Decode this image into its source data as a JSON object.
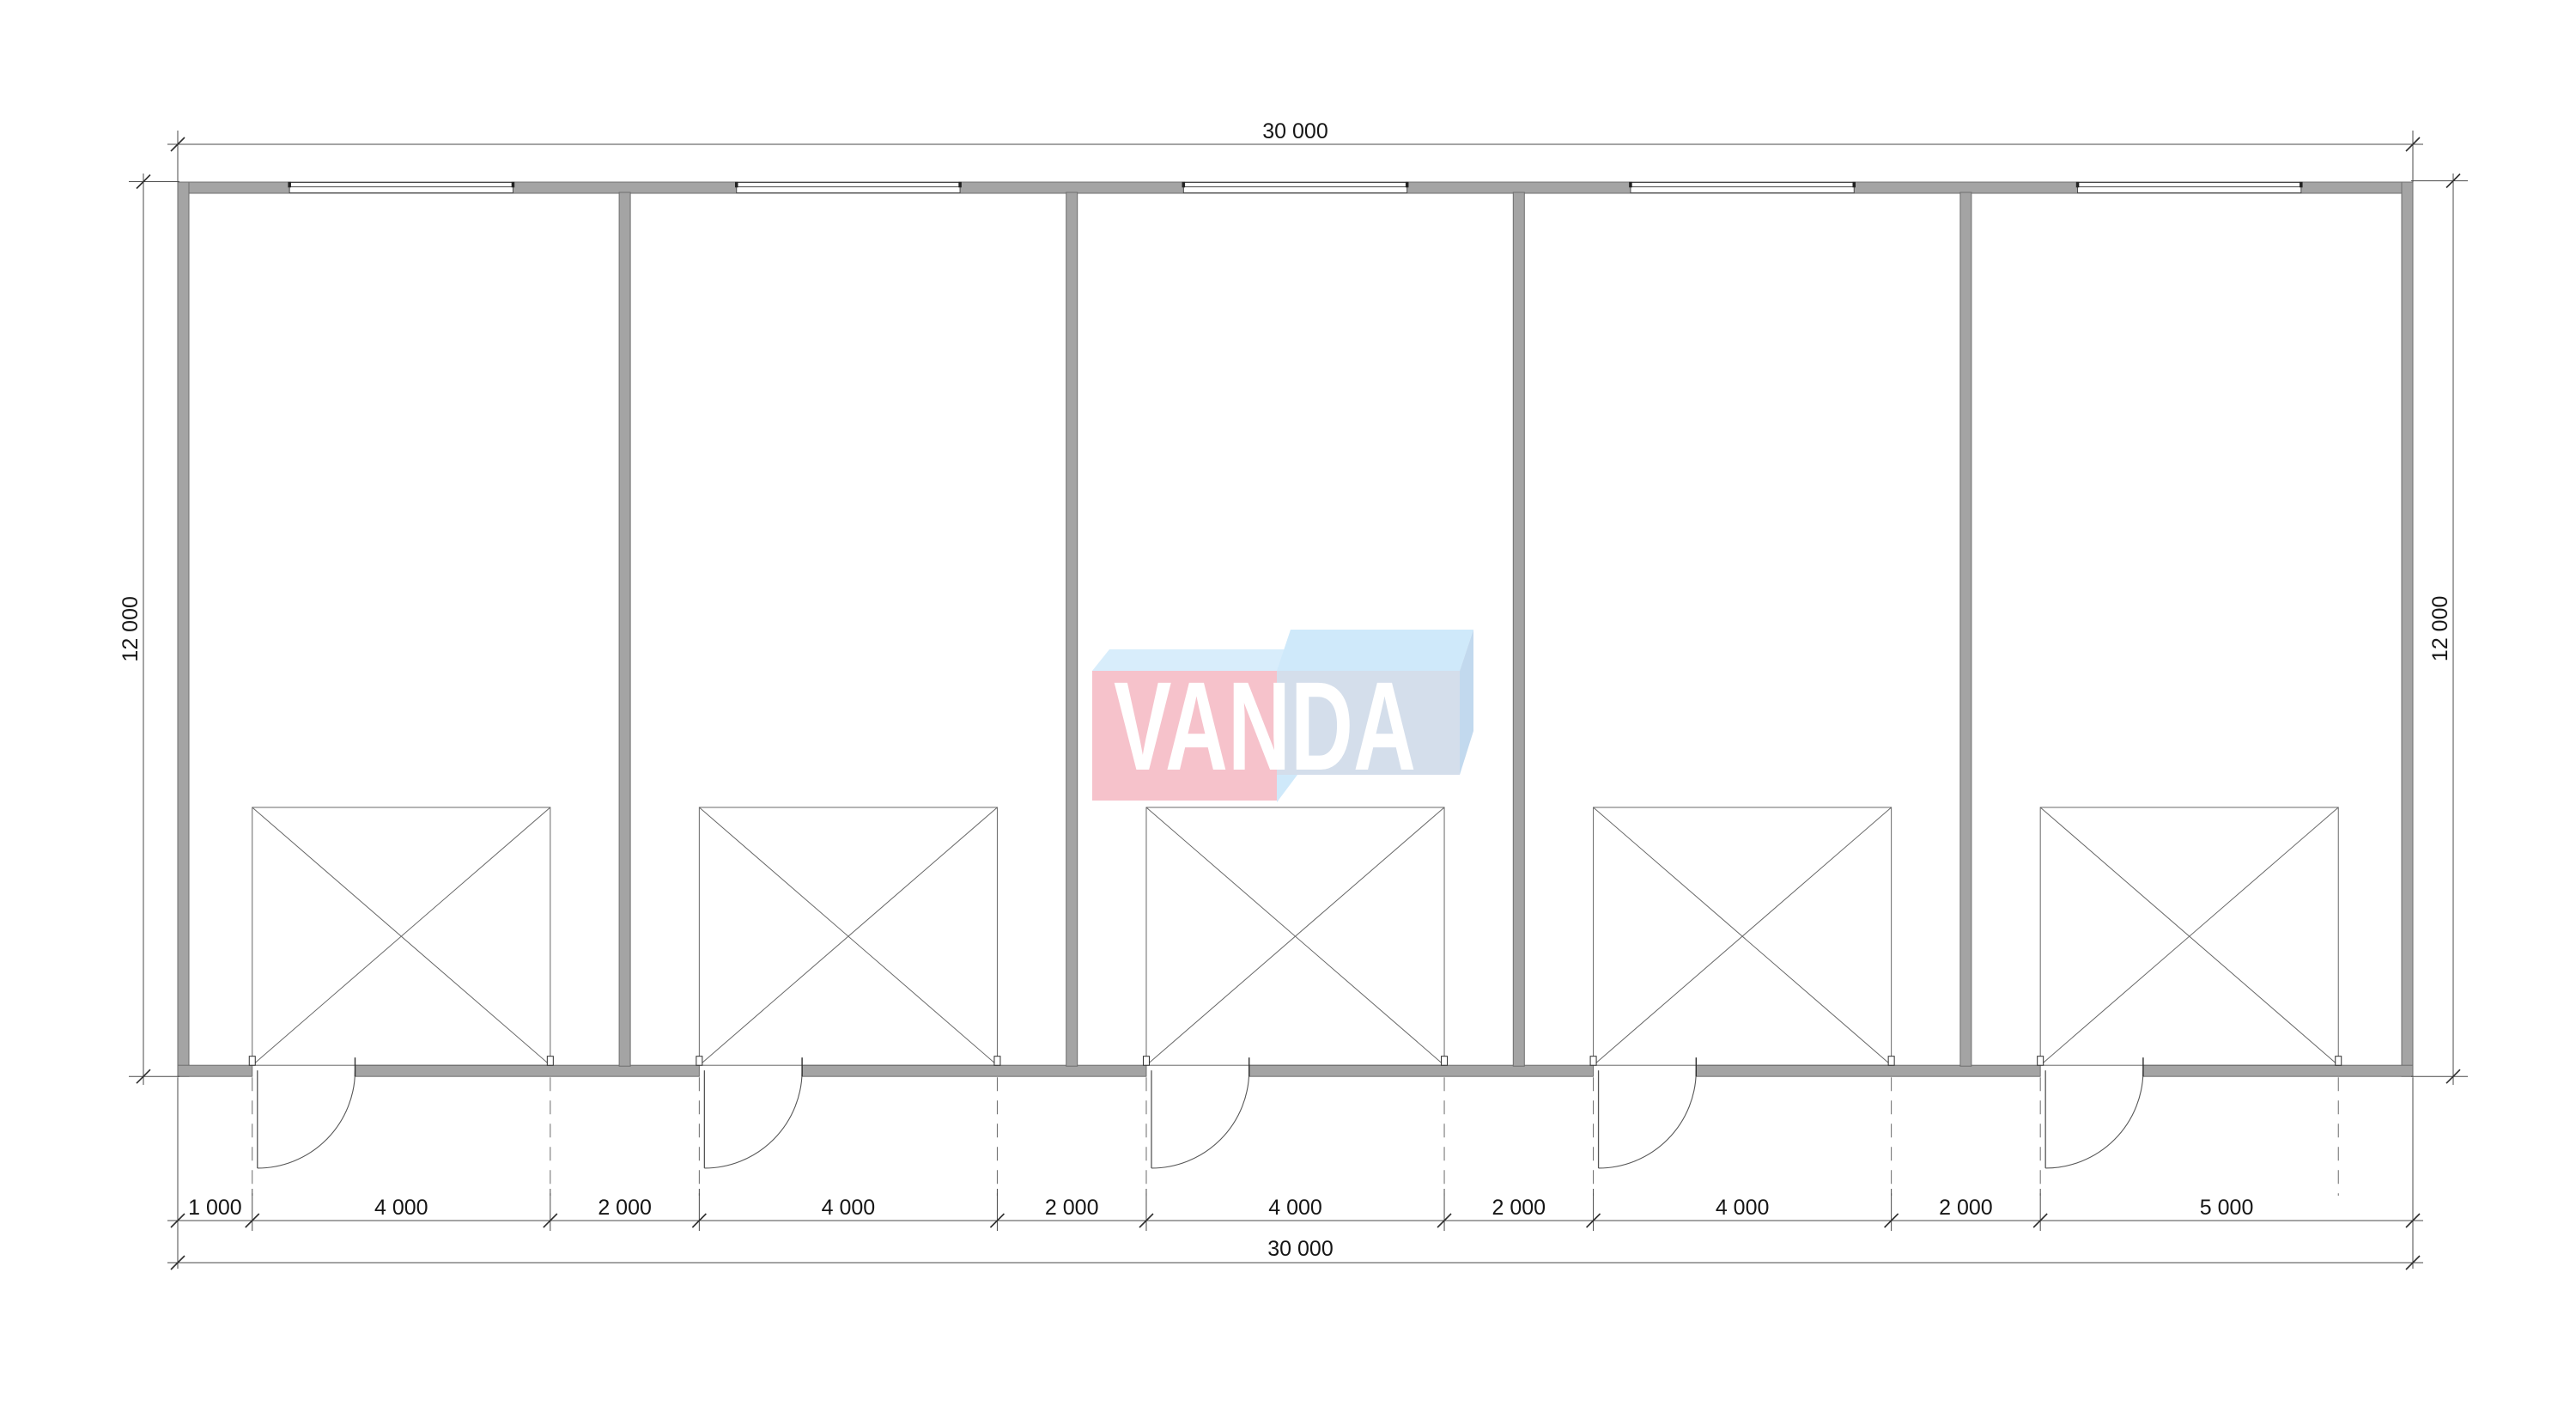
{
  "logo": {
    "text": "VANDA",
    "pink": "#f6c2cb",
    "sky": "#d8edfb",
    "sky2": "#cfe9fa",
    "face": "#d4deeb",
    "side": "#c2d9ee",
    "text_color": "#ffffff"
  },
  "dimensions": {
    "top_overall": "30 000",
    "bottom_overall": "30 000",
    "left_overall": "12 000",
    "right_overall": "12 000",
    "bottom_chain_labels": [
      "1 000",
      "4 000",
      "2 000",
      "4 000",
      "2 000",
      "4 000",
      "2 000",
      "4 000",
      "2 000",
      "5 000"
    ]
  },
  "plan": {
    "building_width_mm": 30000,
    "building_depth_mm": 12000,
    "unit_count": 5,
    "wall_thickness_mm": 150,
    "chain_points_mm": [
      0,
      1000,
      5000,
      7000,
      11000,
      13000,
      17000,
      19000,
      23000,
      25000,
      30000
    ],
    "partition_centers_mm": [
      6000,
      12000,
      18000,
      24000
    ],
    "window_centers_mm": [
      3000,
      9000,
      15000,
      21000,
      27000
    ],
    "window_width_mm": 3000,
    "gate_zone_left_mm": [
      1000,
      7000,
      13000,
      19000,
      25000
    ],
    "gate_zone_width_mm": 4000,
    "gate_zone_depth_mm": 3460,
    "door_width_mm": 1380,
    "colors": {
      "wall_fill": "#a4a4a4",
      "wall_stroke": "#6e6e6e",
      "line": "#686868",
      "dim": "#4a4a4a",
      "tick": "#2f2f2f",
      "dash": "#6a6a6a",
      "window_line": "#4a4a4a"
    }
  }
}
